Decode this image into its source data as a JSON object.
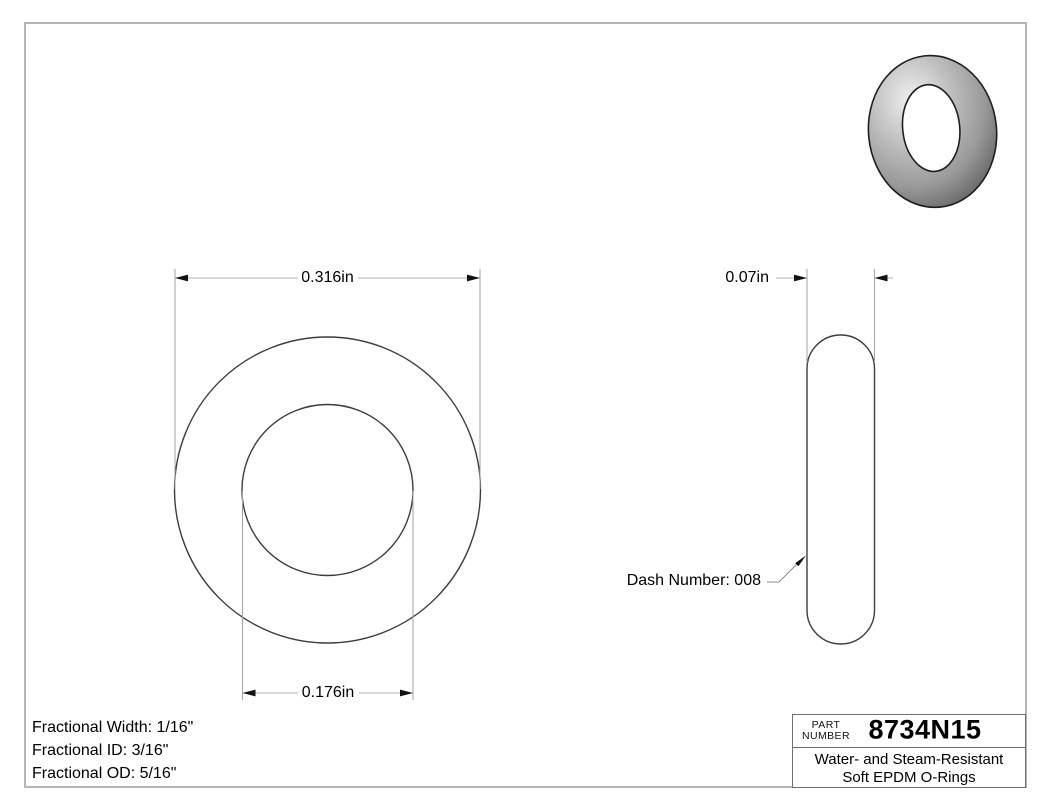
{
  "front_view": {
    "od_dim": "0.316in",
    "id_dim": "0.176in"
  },
  "side_view": {
    "width_dim": "0.07in",
    "dash_note": "Dash Number: 008"
  },
  "notes": [
    "Fractional Width: 1/16\"",
    "Fractional ID: 3/16\"",
    "Fractional OD: 5/16\""
  ],
  "title_block": {
    "part_label_top": "PART",
    "part_label_bottom": "NUMBER",
    "part_number": "8734N15",
    "description_line1": "Water- and Steam-Resistant",
    "description_line2": "Soft EPDM O-Rings"
  },
  "colors": {
    "outline": "#3d3d3d",
    "extension_line": "#a3a3a3",
    "dimension_line": "#b0b0b0",
    "arrow": "#111111",
    "frame": "#b5b5b5",
    "oring_body": "#a8a8a8"
  }
}
